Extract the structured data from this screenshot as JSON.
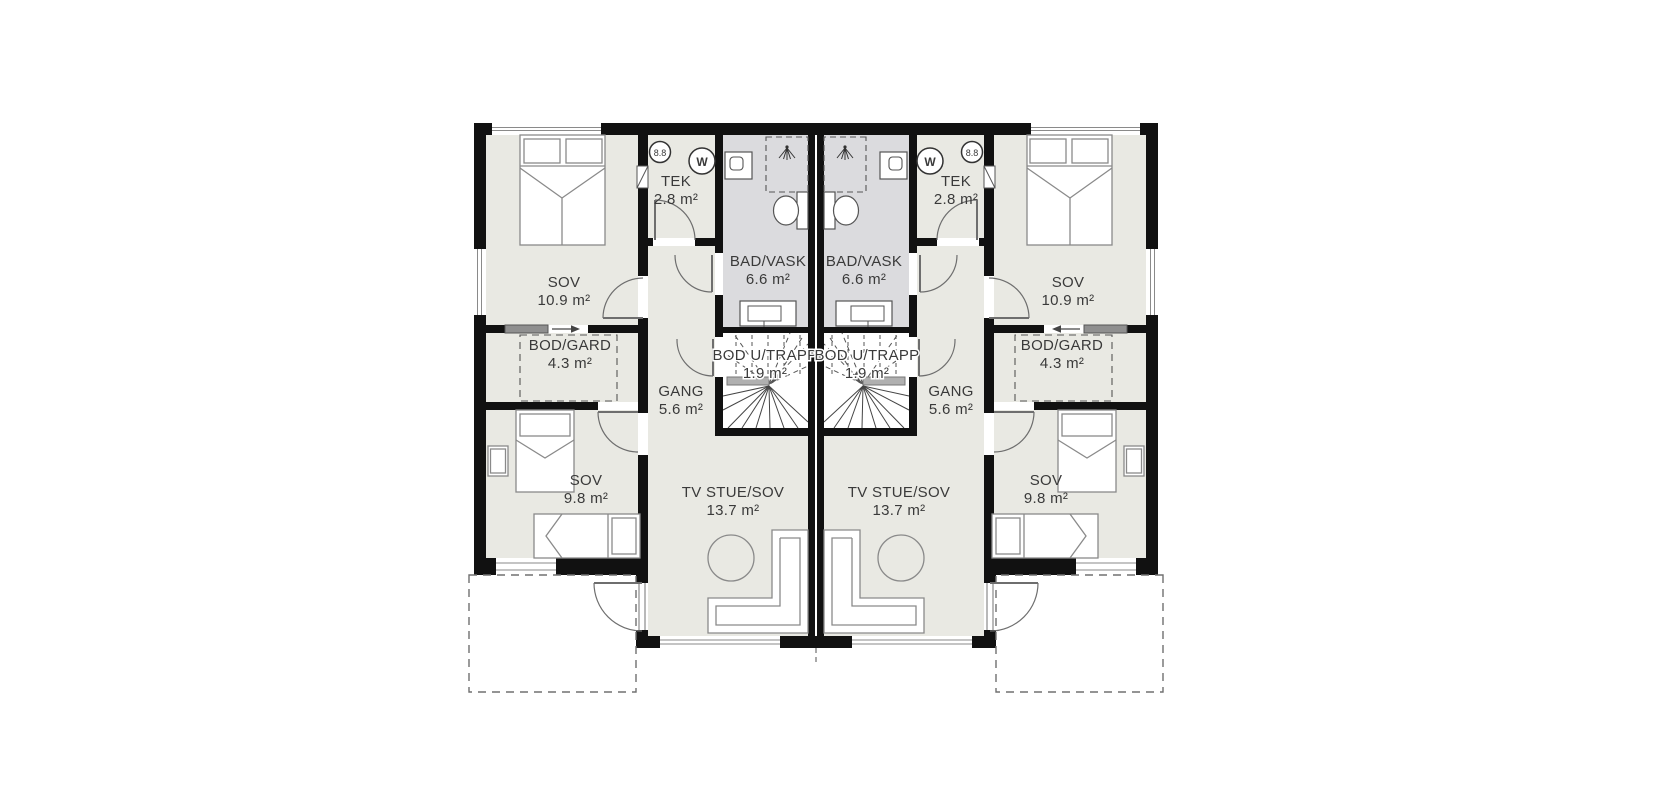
{
  "canvas": {
    "width": 1670,
    "height": 800,
    "background": "#ffffff"
  },
  "colors": {
    "wall": "#111111",
    "floor": "#e9e9e3",
    "bathroom_floor": "#dbdbde",
    "stair_floor": "#ffffff",
    "furniture_line": "#8a8a8a",
    "door_line": "#6e6e6e",
    "dashed_line": "#707070",
    "label_text": "#3a3a3a",
    "sliding_panel": "#8f8f8f",
    "stair_door_strip": "#b0b0b0"
  },
  "plan_type": "floor-plan",
  "units": [
    {
      "id": "unit-left",
      "rooms": [
        {
          "key": "sov_large",
          "name": "SOV",
          "area": "10.9 m²"
        },
        {
          "key": "tek",
          "name": "TEK",
          "area": "2.8 m²"
        },
        {
          "key": "bad_vask",
          "name": "BAD/VASK",
          "area": "6.6 m²"
        },
        {
          "key": "bod_gard",
          "name": "BOD/GARD",
          "area": "4.3 m²"
        },
        {
          "key": "gang",
          "name": "GANG",
          "area": "5.6 m²"
        },
        {
          "key": "bod_u_trapp",
          "name": "BOD U/TRAPP",
          "area": "1.9 m²"
        },
        {
          "key": "sov_small",
          "name": "SOV",
          "area": "9.8 m²"
        },
        {
          "key": "tv_stue",
          "name": "TV STUE/SOV",
          "area": "13.7 m²"
        }
      ],
      "fixtures": {
        "water_heater_label": "8.8",
        "washing_machine_label": "W"
      }
    },
    {
      "id": "unit-right",
      "rooms": [
        {
          "key": "sov_large",
          "name": "SOV",
          "area": "10.9 m²"
        },
        {
          "key": "tek",
          "name": "TEK",
          "area": "2.8 m²"
        },
        {
          "key": "bad_vask",
          "name": "BAD/VASK",
          "area": "6.6 m²"
        },
        {
          "key": "bod_gard",
          "name": "BOD/GARD",
          "area": "4.3 m²"
        },
        {
          "key": "gang",
          "name": "GANG",
          "area": "5.6 m²"
        },
        {
          "key": "bod_u_trapp",
          "name": "BOD U/TRAPP",
          "area": "1.9 m²"
        },
        {
          "key": "sov_small",
          "name": "SOV",
          "area": "9.8 m²"
        },
        {
          "key": "tv_stue",
          "name": "TV STUE/SOV",
          "area": "13.7 m²"
        }
      ],
      "fixtures": {
        "water_heater_label": "8.8",
        "washing_machine_label": "W"
      }
    }
  ]
}
